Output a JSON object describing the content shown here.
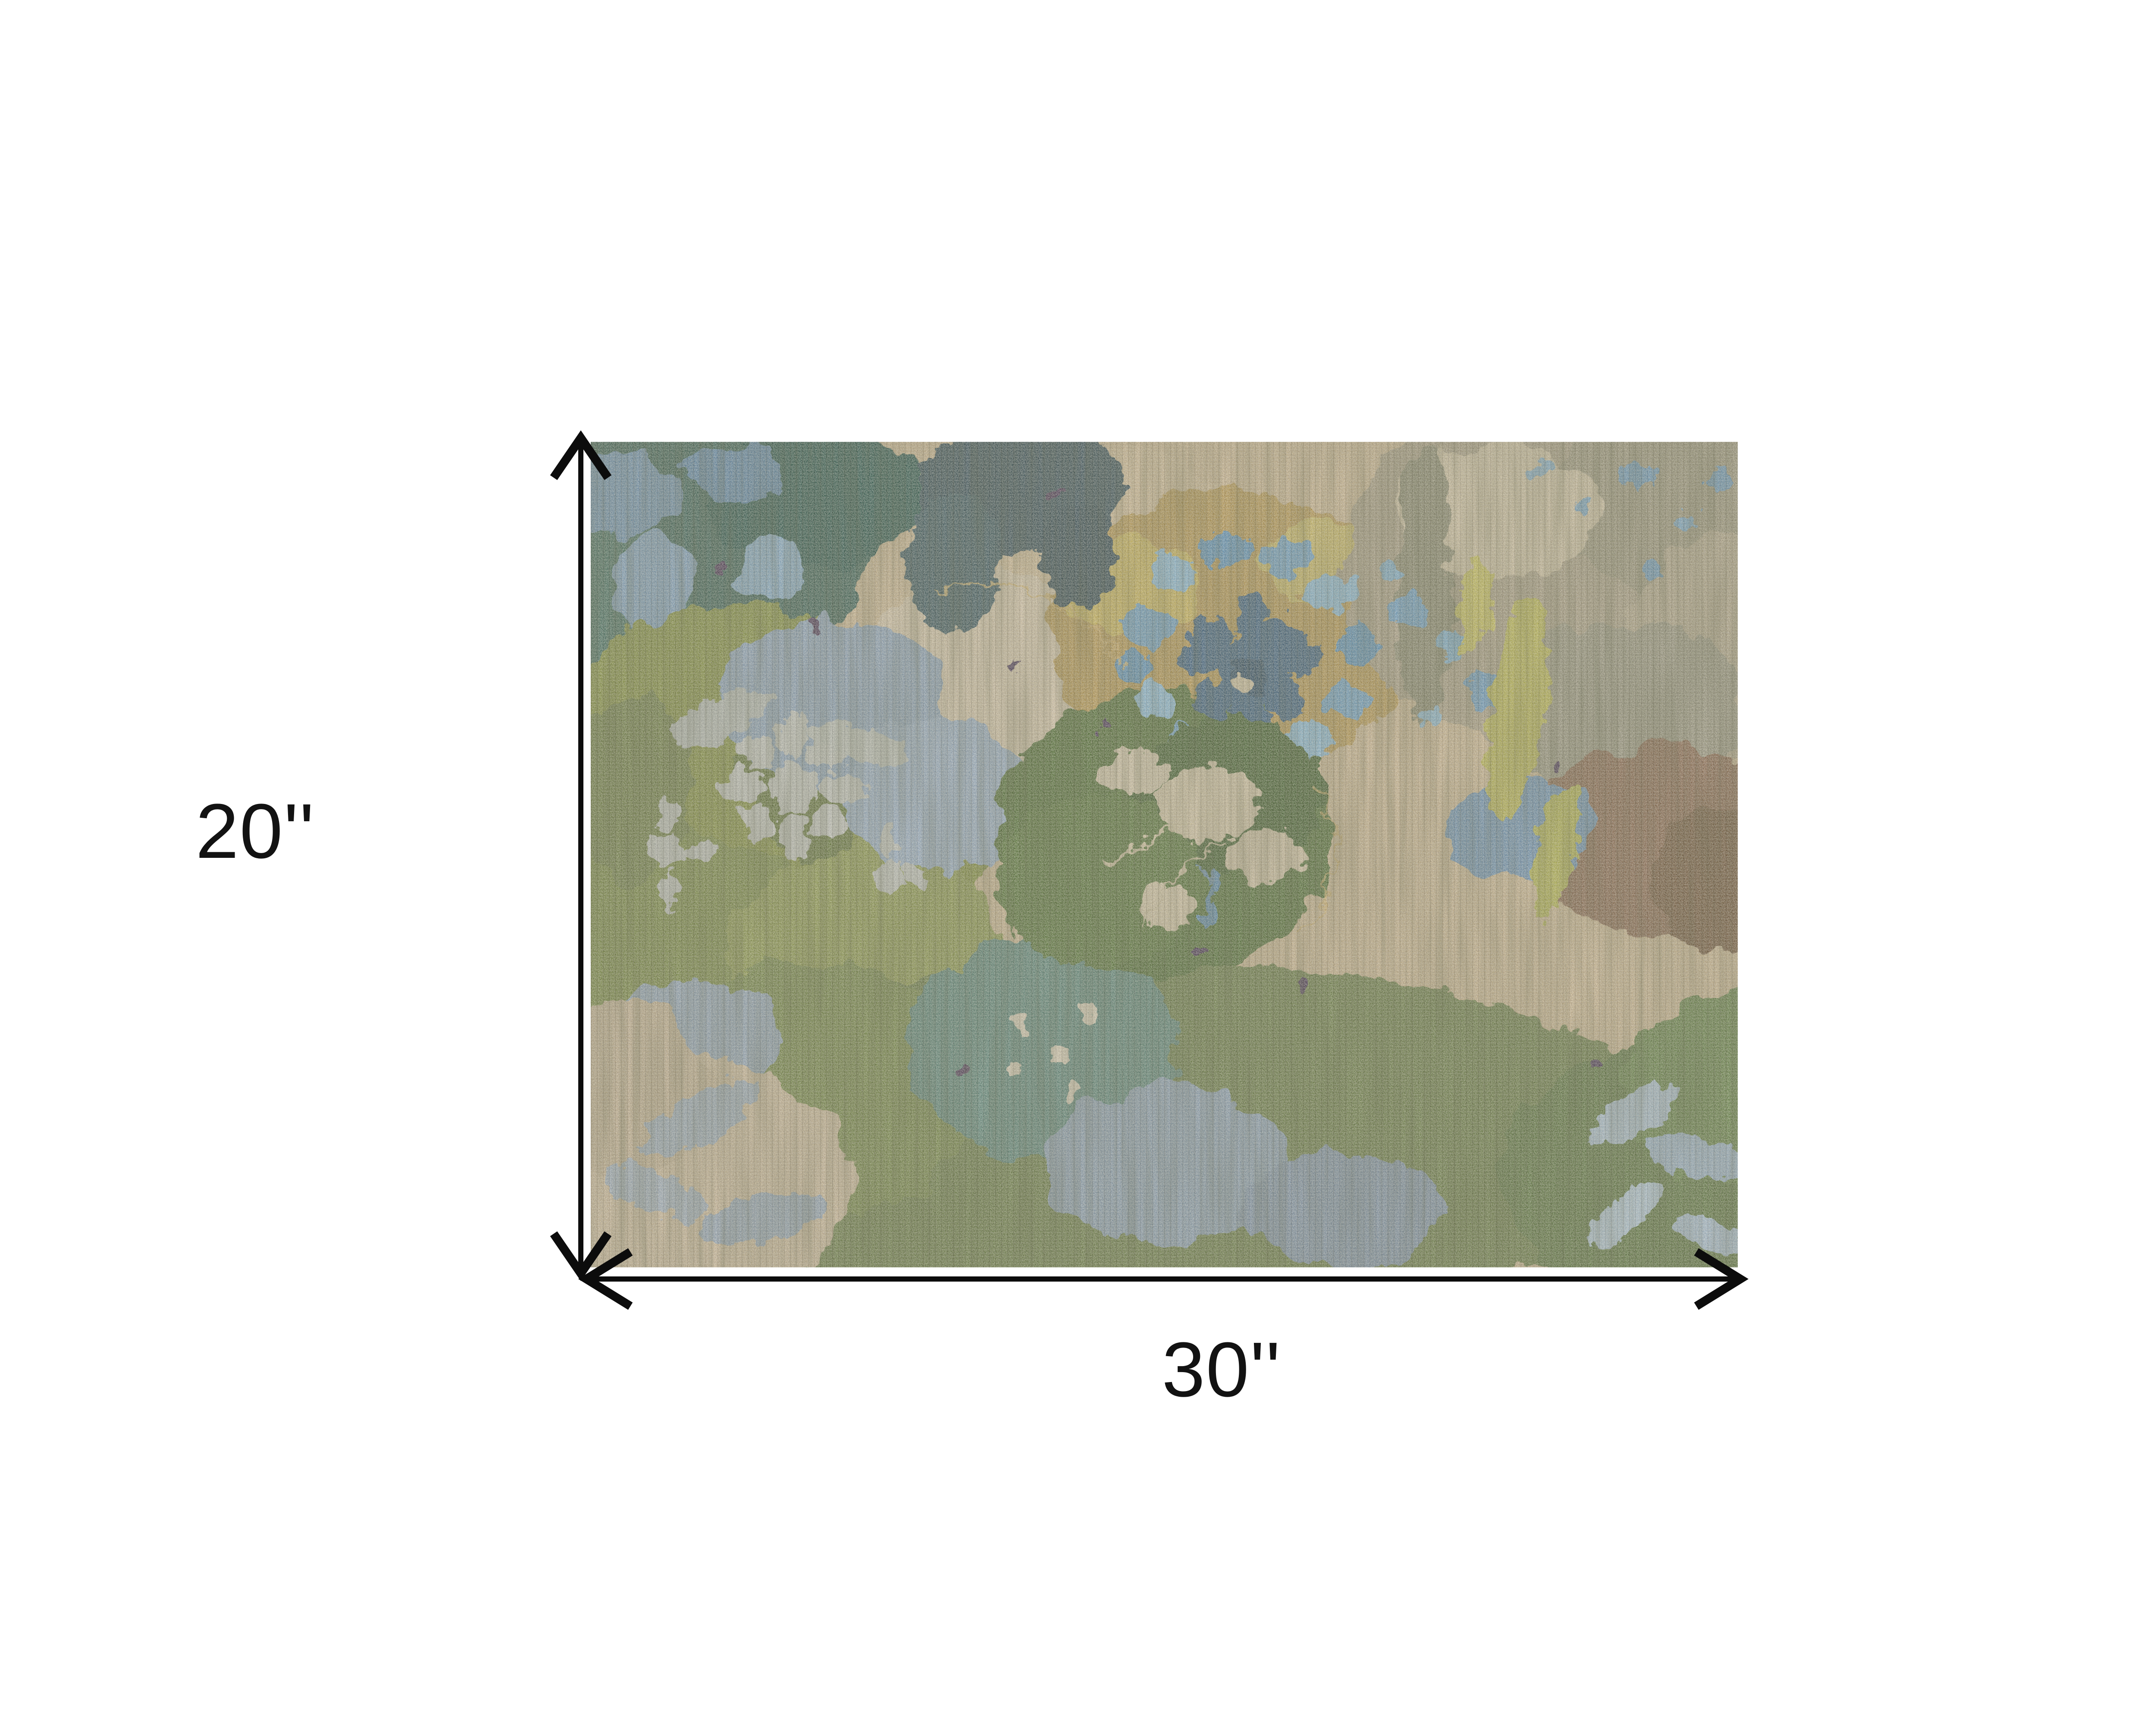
{
  "page": {
    "background_color": "#ffffff"
  },
  "diagram": {
    "type": "product-dimensions",
    "item": "Distressed abstract floral area rug in greens, blues, tans and browns",
    "height_label": "20''",
    "width_label": "30''",
    "arrow_color": "#0c0c0c",
    "label_color": "#121212",
    "rug_palette": {
      "tan_base": "#c1ac83",
      "dark_teal": "#2b5245",
      "olive_green": "#75832f",
      "moss_green": "#5c7034",
      "gold": "#ad8d41",
      "flower_blue": "#6096ba",
      "navy": "#2c5170",
      "blue_gray": "#7b93a5",
      "brown": "#7b5a3c",
      "pale_gray": "#b6bab0",
      "dark_green": "#3f5e20",
      "teal": "#4e796a"
    }
  }
}
